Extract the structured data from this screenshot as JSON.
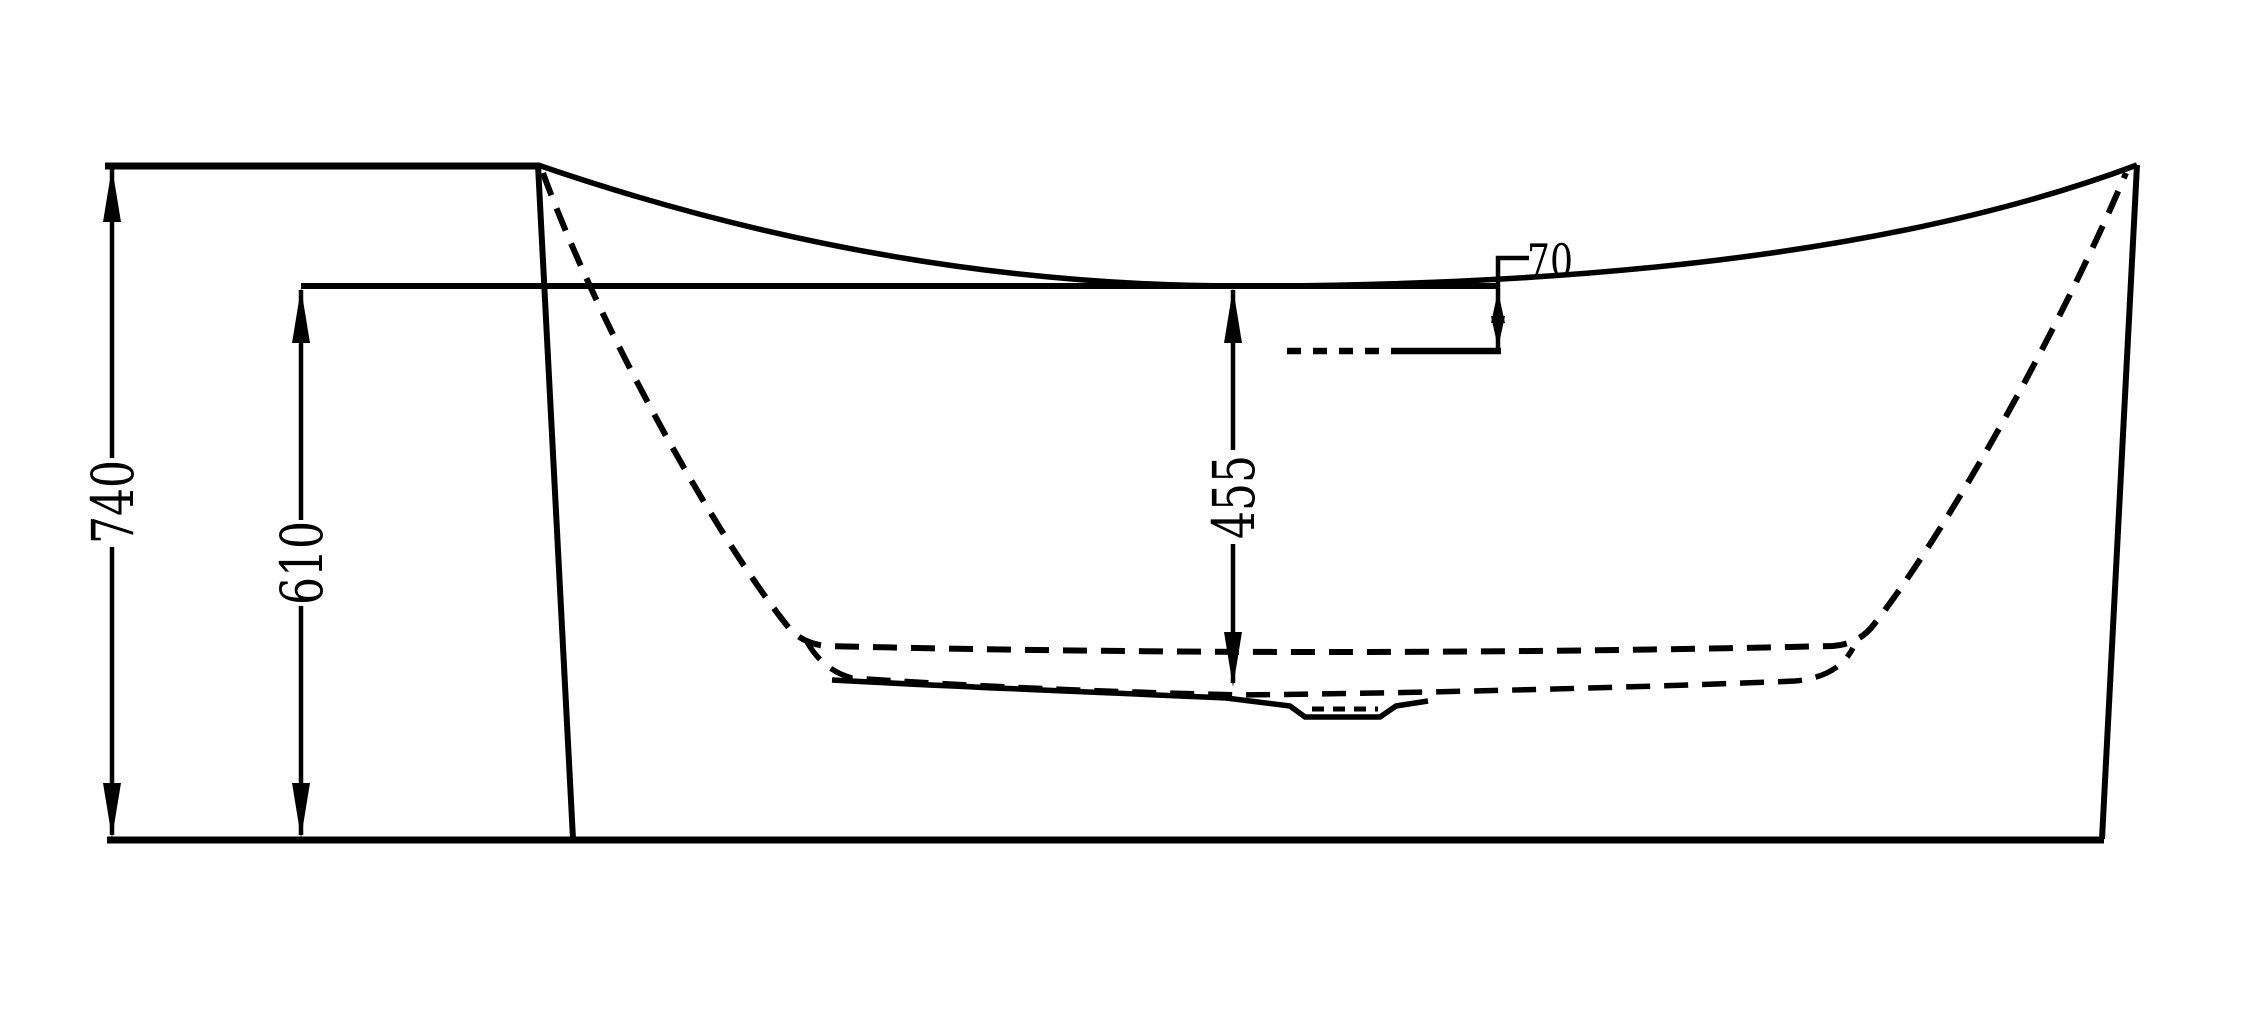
{
  "diagram": {
    "kind": "technical-drawing",
    "subject": "bathtub-side-elevation",
    "line_color": "#000000",
    "background_color": "#ffffff",
    "dimensions": {
      "overall_height": {
        "label": "740"
      },
      "waterline_height": {
        "label": "610"
      },
      "waterline_to_floor_depth": {
        "label": "455"
      },
      "rim_to_waterline_offset": {
        "label": "70"
      }
    }
  }
}
